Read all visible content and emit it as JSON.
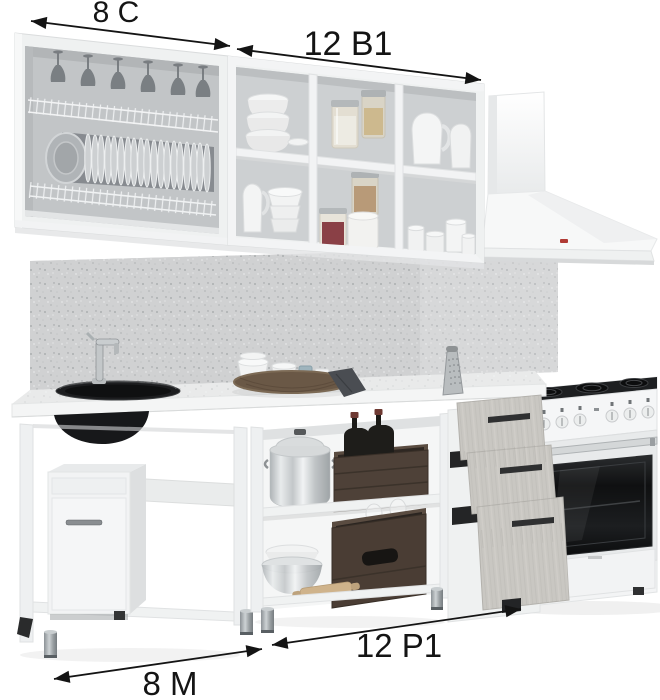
{
  "image": {
    "kind": "kitchen furniture set product photo with module dimension annotations",
    "background": "#ffffff"
  },
  "labels": {
    "upper_left": "8 C",
    "upper_middle": "12 B1",
    "lower_left": "8 M",
    "lower_middle": "12 P1"
  },
  "modules": [
    {
      "code": "8 C",
      "area": "upper-left",
      "description": "open wall cabinet with hanging stemware and plate drying rack"
    },
    {
      "code": "12 B1",
      "area": "upper-middle",
      "description": "open wall shelf unit, 3x2 compartments with bowls, jars, pitchers and cups"
    },
    {
      "code": "8 M",
      "area": "lower-left",
      "description": "sink base unit with black inset sink, mixer tap and small utility cabinet"
    },
    {
      "code": "12 P1",
      "area": "lower-middle",
      "description": "work base unit with two open shelves and three pull-out drawers"
    }
  ],
  "appliances": [
    {
      "name": "chimney range hood",
      "color": "#f6f7f7",
      "logo_color": "#b03a34"
    },
    {
      "name": "freestanding cooker with oven",
      "body_color": "#f4f5f5",
      "oven_door_color": "#141414"
    }
  ],
  "props": [
    "wine glasses",
    "plates in drying rack",
    "stacked bowls",
    "glass storage jars",
    "white pitchers",
    "cups",
    "stock pot with lid",
    "wine bottles in wooden crate",
    "stemware in wooden crate",
    "mixing bowls",
    "rolling pin",
    "wicker tray with ramekins",
    "kitchen towel",
    "box grater",
    "mixer tap"
  ],
  "colors": {
    "annotation": "#141414",
    "cabinet_white": "#eff1f1",
    "interior_gray": "#cbced0",
    "backsplash": "#d0d1d2",
    "countertop": "#e9eaea",
    "sink_black": "#17181a",
    "drawer_front": "#c9c7c2",
    "handle_dark": "#2f3031",
    "crate_wood": "#4e4138",
    "leg_metal": "#9aa0a3"
  }
}
